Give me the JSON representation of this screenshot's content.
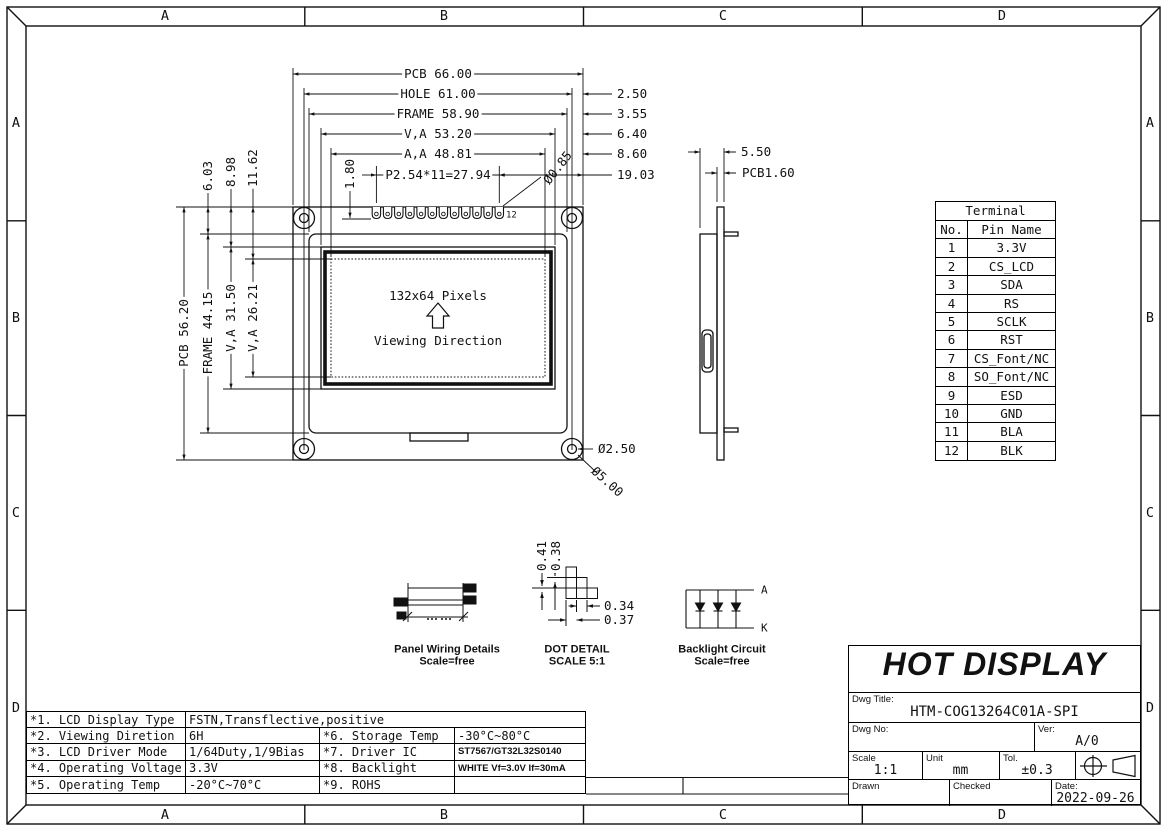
{
  "zones": {
    "top": [
      "A",
      "B",
      "C",
      "D"
    ],
    "bottom": [
      "A",
      "B",
      "C",
      "D"
    ],
    "left": [
      "A",
      "B",
      "C",
      "D"
    ],
    "right": [
      "A",
      "B",
      "C",
      "D"
    ]
  },
  "front_view": {
    "screen": "132x64 Pixels",
    "viewing": "Viewing Direction",
    "dim_pcb_w": "PCB 66.00",
    "dim_hole_w": "HOLE 61.00",
    "dim_frame_w": "FRAME 58.90",
    "dim_va_w": "V,A 53.20",
    "dim_aa_w": "A,A 48.81",
    "dim_pitch": "P2.54*11=27.94",
    "dim_edge_hole": "2.50",
    "dim_edge_frame": "3.55",
    "dim_edge_va": "6.40",
    "dim_edge_aa": "8.60",
    "dim_pin_edge": "19.03",
    "dim_pcb_h": "PCB 56.20",
    "dim_frame_h": "FRAME 44.15",
    "dim_va_h": "V,A 31.50",
    "dim_aa_h": "V,A 26.21",
    "dim_frame_top": "6.03",
    "dim_va_top": "8.98",
    "dim_aa_top": "11.62",
    "dim_pad_len": "1.80",
    "dim_pad_hole": "Ø0.85",
    "pin_last_no": "12",
    "dim_mount_hole": "Ø2.50",
    "dim_mount_pad": "Ø5.00"
  },
  "side_view": {
    "dim_total": "5.50",
    "dim_pcb_t": "PCB1.60"
  },
  "terminal": {
    "title": "Terminal",
    "col_no": "No.",
    "col_name": "Pin Name",
    "rows": [
      [
        "1",
        "3.3V"
      ],
      [
        "2",
        "CS_LCD"
      ],
      [
        "3",
        "SDA"
      ],
      [
        "4",
        "RS"
      ],
      [
        "5",
        "SCLK"
      ],
      [
        "6",
        "RST"
      ],
      [
        "7",
        "CS_Font/NC"
      ],
      [
        "8",
        "SO_Font/NC"
      ],
      [
        "9",
        "ESD"
      ],
      [
        "10",
        "GND"
      ],
      [
        "11",
        "BLA"
      ],
      [
        "12",
        "BLK"
      ]
    ]
  },
  "details": {
    "panel_wiring": {
      "caption": "Panel Wiring Details",
      "scale": "Scale=free"
    },
    "dot_detail": {
      "caption": "DOT DETAIL",
      "scale": "SCALE 5:1",
      "dim_v1": "0.41",
      "dim_v2": "0.38",
      "dim_h1": "0.34",
      "dim_h2": "0.37"
    },
    "backlight": {
      "caption": "Backlight Circuit",
      "scale": "Scale=free",
      "anode": "A",
      "cathode": "K"
    }
  },
  "spec": {
    "rows": [
      {
        "c1": "*1. LCD Display Type",
        "c2": "FSTN,Transflective,positive",
        "c3": "",
        "c4": ""
      },
      {
        "c1": "*2. Viewing Diretion",
        "c2": "6H",
        "c3": "*6. Storage Temp",
        "c4": "-30°C~80°C"
      },
      {
        "c1": "*3. LCD Driver Mode",
        "c2": "1/64Duty,1/9Bias",
        "c3": "*7. Driver IC",
        "c4": "ST7567/GT32L32S0140"
      },
      {
        "c1": "*4. Operating Voltage",
        "c2": "3.3V",
        "c3": "*8. Backlight",
        "c4": "WHITE Vf=3.0V If=30mA"
      },
      {
        "c1": "*5. Operating Temp",
        "c2": "-20°C~70°C",
        "c3": "*9. ROHS",
        "c4": ""
      }
    ]
  },
  "title_block": {
    "company": "HOT DISPLAY",
    "dwg_title_label": "Dwg Title:",
    "dwg_title": "HTM-COG13264C01A-SPI",
    "dwg_no_label": "Dwg No:",
    "ver_label": "Ver:",
    "ver": "A/0",
    "scale_label": "Scale",
    "scale": "1:1",
    "unit_label": "Unit",
    "unit": "mm",
    "tol_label": "Tol.",
    "tol": "±0.3",
    "drawn_label": "Drawn",
    "checked_label": "Checked",
    "date_label": "Date:",
    "date": "2022-09-26"
  }
}
